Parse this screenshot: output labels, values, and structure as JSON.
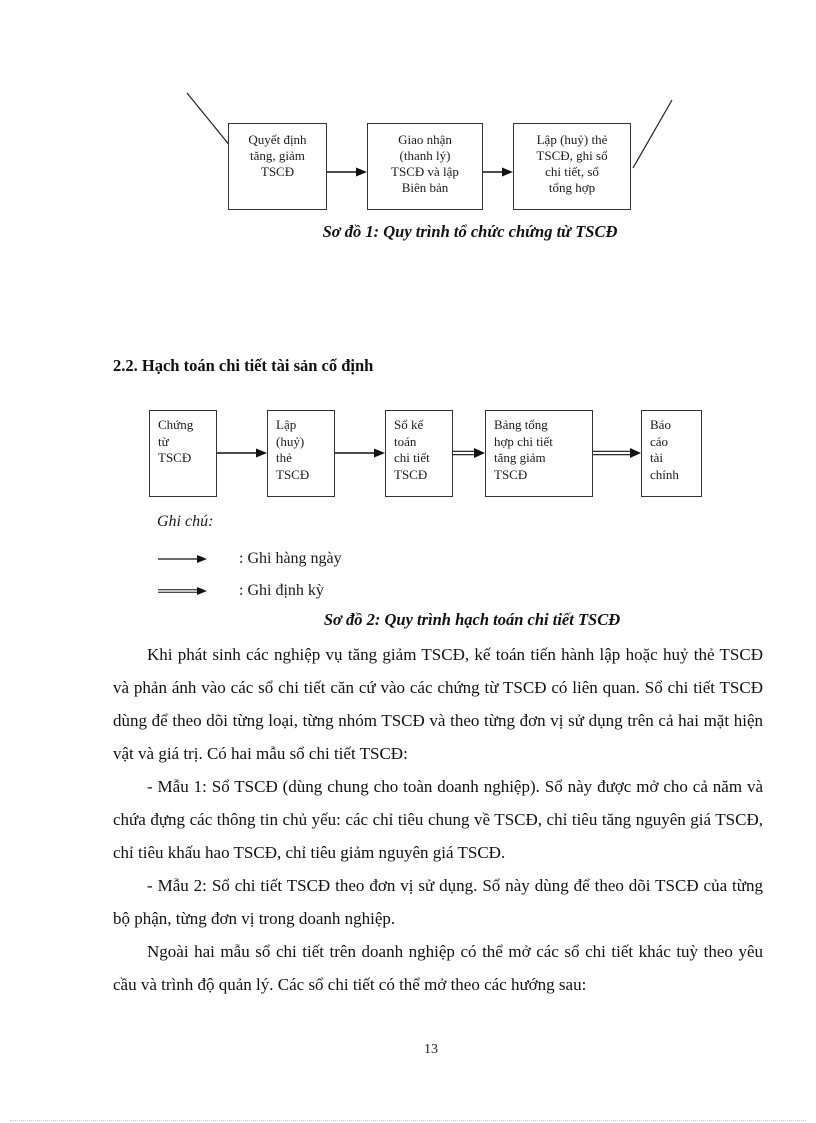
{
  "colors": {
    "ink": "#1a1a1a",
    "box_border": "#333333"
  },
  "diagram1": {
    "boxes": [
      "Quyết định\ntăng, giảm\nTSCĐ",
      "Giao nhận\n(thanh lý)\nTSCĐ và lập\nBiên bản",
      "Lập (huỷ) thẻ\nTSCĐ, ghi sổ\nchi tiết, sổ\ntổng hợp"
    ],
    "caption": "Sơ đồ 1: Quy trình tổ chức chứng từ TSCĐ"
  },
  "section": {
    "heading": "2.2. Hạch toán chi tiết tài sản cố định"
  },
  "diagram2": {
    "boxes": [
      "Chứng\ntừ\nTSCĐ",
      "Lập\n(huỷ)\nthẻ\nTSCĐ",
      "Sổ kế\ntoán\nchi tiết\nTSCĐ",
      "Bảng tổng\nhợp chi tiết\ntăng giảm\nTSCĐ",
      "Báo\ncáo\ntài\nchính"
    ],
    "caption": "Sơ đồ 2: Quy trình hạch toán chi tiết TSCĐ"
  },
  "legend": {
    "title": "Ghi chú:",
    "items": [
      {
        "arrow": "single",
        "label": ": Ghi hàng ngày"
      },
      {
        "arrow": "double",
        "label": ": Ghi định kỳ"
      }
    ]
  },
  "paragraphs": [
    "Khi phát sinh các nghiệp vụ tăng giảm TSCĐ, kế toán tiến hành lập hoặc huỷ thẻ TSCĐ và phản ánh vào các sổ chi tiết căn cứ vào các chứng từ TSCĐ có liên quan. Sổ chi tiết TSCĐ dùng để theo dõi từng loại, từng nhóm TSCĐ và theo từng đơn vị sử dụng trên cả hai mặt hiện vật và giá trị. Có hai mẫu sổ chi tiết TSCĐ:",
    "- Mẫu 1: Sổ TSCĐ (dùng chung cho toàn doanh nghiệp). Sổ này được mở cho cả năm và chứa đựng các thông tin chủ yếu: các chỉ tiêu chung về TSCĐ, chỉ tiêu tăng nguyên giá TSCĐ, chỉ tiêu khấu hao TSCĐ, chỉ tiêu giảm nguyên giá TSCĐ.",
    "- Mẫu 2: Sổ chi tiết TSCĐ theo đơn vị sử dụng. Sổ này dùng để theo dõi TSCĐ của từng bộ phận, từng đơn vị trong doanh nghiệp.",
    "Ngoài hai mẫu sổ chi tiết trên doanh nghiệp có thể mở các sổ chi tiết khác tuỳ theo yêu cầu và trình độ quản lý. Các sổ chi tiết có thể mở theo các hướng sau:"
  ],
  "page": {
    "number": "13"
  }
}
